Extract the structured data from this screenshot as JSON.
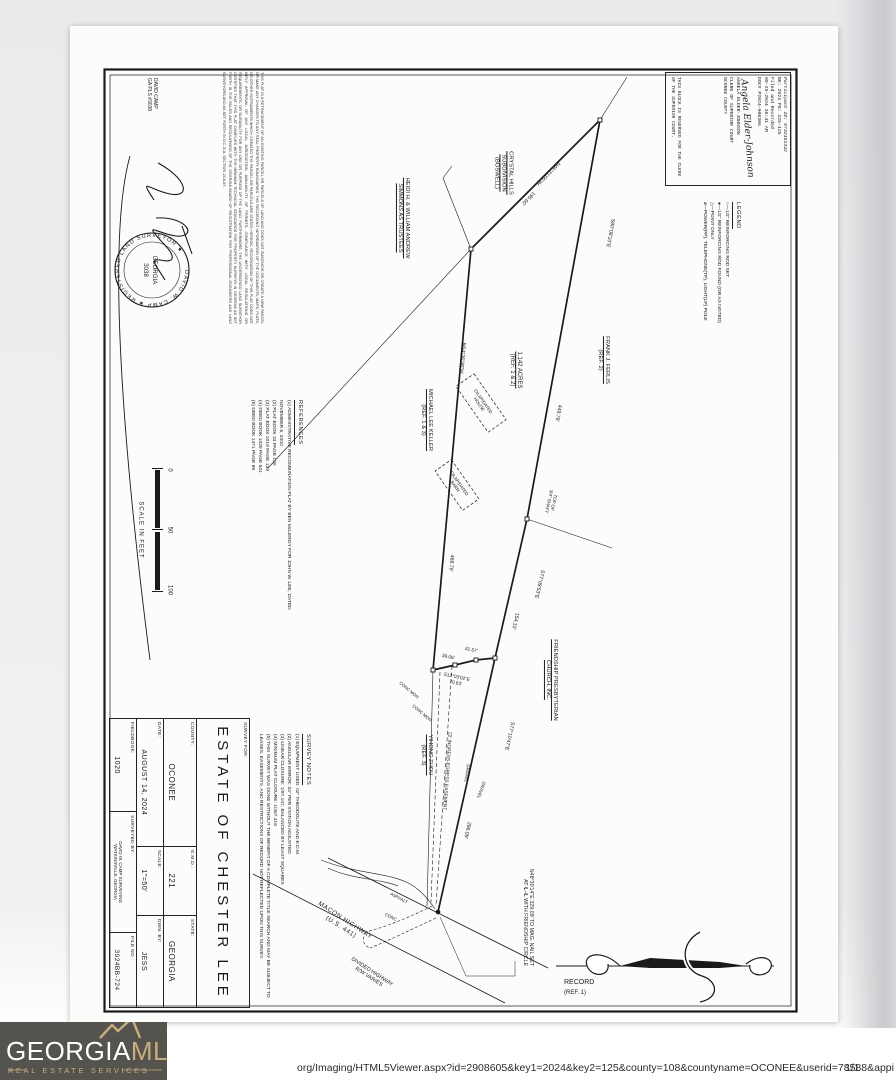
{
  "viewer": {
    "url_text": "org/Imaging/HTML5Viewer.aspx?id=2908605&key1=2024&key2=125&county=108&countyname=OCONEE&userid=78588&appi",
    "page_indicator": "1/1"
  },
  "logo": {
    "name_primary": "GEORGIA",
    "name_accent": "MLS",
    "tagline": "REAL ESTATE SERVICES",
    "bg_color": "#55534e",
    "gold_color": "#c8ad7e"
  },
  "clerk_block": {
    "participant": "Participant ID: 8732451342",
    "book_page": "BK: 2024 PG: 125-125",
    "filed": "Filed and Recorded",
    "datetime": "08-29-2024 10:41 AM",
    "doc_no": "DOC# P2024-000306",
    "signature": "Angela Elder-Johnson",
    "clerk_name": "ANGELA ELDER-JOHNSON",
    "clerk_title": "CLERK OF SUPERIOR COURT",
    "county": "OCONEE COUNTY",
    "reserved_note": "THIS BLOCK IS RESERVED FOR THE CLERK OF THE SUPERIOR COURT."
  },
  "legend": {
    "title": "LEGEND",
    "items": [
      "○—1/2\" REINFORCING ROD SET",
      "●—1/2\" REINFORCING ROD FOUND (OR AS NOTED)",
      "△—POINT ONLY",
      "⌀—POWER(PP), TELEPHONE(TP), LIGHT(LP) POLE"
    ]
  },
  "certification": {
    "text": "THIS PLAT IS A RETRACEMENT OF AN EXISTING PARCEL OR PARCELS OF LAND AND DOES NOT SUBDIVIDE OR CREATE A NEW PARCEL OR MAKE ANY CHANGES TO ANY REAL PROPERTY BOUNDARIES. THE RECORDING INFORMATION OF THE DOCUMENTS, MAPS, PLATS, OR OTHER INSTRUMENTS WHICH CREATED THE PARCEL OR PARCELS ARE STATED HEREON. RECORDATION OF THIS PLAT DOES NOT IMPLY APPROVAL OF ANY LOCAL JURISDICTION, AVAILABILITY OF PERMITS, COMPLIANCE WITH LOCAL REGULATIONS OR REQUIREMENTS, OR SUITABILITY FOR ANY USE OR PURPOSE OF THE LAND. FURTHERMORE, THE UNDERSIGNED LAND SURVEYOR CERTIFIES THAT THIS PLAT COMPLIES WITH THE MINIMUM TECHNICAL STANDARDS FOR PROPERTY SURVEYS IN GEORGIA AS SET FORTH IN THE RULES AND REGULATIONS OF THE GEORGIA BOARD OF REGISTRATION FOR PROFESSIONAL ENGINEERS AND LAND SURVEYORS AND AS SET FORTH IN O.C.G.A. SECTION 15-6-67.",
    "surveyor_note": [
      "DAVID CAMP",
      "GA PLS #3038"
    ],
    "seal_ring": "DAVID W. CAMP ★ REGISTERED LAND SURVEYOR ★",
    "seal_center": [
      "GEORGIA",
      "3038"
    ]
  },
  "references": {
    "title": "REFERENCES",
    "items": [
      "(1) ADMINISTRATIVE RECOMBINATION PLAT BY BEN McLEROY FOR JOHN W. LEE, DATED NOVEMBER 6, 2000",
      "(2) PLAT BOOK 33 PAGE 100",
      "(3) PLAT BOOK 2019 PAGE 139",
      "(4) DEED BOOK 1029 PAGE 501",
      "(5) DEED BOOK 1471 PAGE 89"
    ]
  },
  "survey_notes": {
    "title": "SURVEY NOTES",
    "items": [
      "(1) EQUIPMENT USED: 02\" THEODOLITE AND E.D.M.",
      "(2) ANGULAR ERROR: 04\" PER STATION ADJUSTED",
      "(3) LINEAR CLOSURE: 1/97,107, BALANCED BY LEAST SQUARES",
      "(4) MINIMUM PLAT CLOSURE: 1/467,316",
      "(5) THIS SURVEY WAS DONE WITHOUT THE BENEFIT OF A COMPLETE TITLE SEARCH AND MAY BE SUBJECT TO LEASES, EASEMENTS, AND RESTRICTIONS OF RECORD NOT REFLECTED UPON THIS SURVEY."
    ]
  },
  "scale_bar": {
    "ticks": [
      "0",
      "50",
      "100"
    ],
    "caption": "SCALE IN FEET"
  },
  "title_block": {
    "survey_for_label": "SURVEY FOR:",
    "client_name": "ESTATE OF CHESTER LEE",
    "county_label": "COUNTY:",
    "county": "OCONEE",
    "gmd_label": "G.M.D.:",
    "gmd": "221",
    "state_label": "STATE:",
    "state": "GEORGIA",
    "date_label": "DATE:",
    "date": "AUGUST 14, 2024",
    "scale_label": "SCALE:",
    "scale": "1\"=50'",
    "drawn_label": "DWN. BY:",
    "drawn_by": "JESS",
    "fieldbook_label": "FIELDBOOK:",
    "fieldbook": "1020",
    "surveyed_label": "SURVEYED BY:",
    "surveyed_by": [
      "DAVID W. CAMP SURVEYING",
      "WATKINSVILLE, GEORGIA"
    ],
    "file_label": "FILE NO.:",
    "file_no": "3924BB-724"
  },
  "parcel": {
    "area": [
      "1.142 ACRES",
      "(REF. 1 & 2)"
    ],
    "calls": {
      "ab": {
        "bearing": "N46°21'05\"W",
        "distance": "195.60'"
      },
      "ae": {
        "bearing": "S80°08'10\"E",
        "distance": "449.78'"
      },
      "bc": {
        "bearing": "N64°26'38\"W",
        "distance": "468.79'"
      },
      "ef": {
        "bearing": "S77°08'53\"E",
        "distance": "154.10'"
      },
      "fg": {
        "bearing": "S77°10'47\"E",
        "distance": "286.09'"
      },
      "jog": {
        "bearing": "S12°03'02\"E",
        "distance": "70.63'"
      },
      "jog1": "31.57'",
      "jog2": "39.06'"
    },
    "adjoiners": {
      "crystal_hills": [
        "CRYSTAL HILLS",
        "SUBDIVISION",
        "(BOSWELL)"
      ],
      "simmons": [
        "HEIDI H. & WILLIAM ANDREW",
        "SIMMONS AS TRUSTEES"
      ],
      "ferlis": [
        "FRANK J. FERLIS",
        "(REF. 2)"
      ],
      "keller": [
        "MICHAEL LEE KELLER",
        "(REF. 1 & 3)"
      ],
      "church": [
        "FRIENDSHIP PRESBYTERIAN",
        "CHURCH, INC."
      ],
      "zhou": [
        "YIHONG ZHOU",
        "(REF. 3)"
      ]
    },
    "features": {
      "shaft": [
        "TOP OF",
        "3/4\" SHAFT"
      ],
      "conc_mon": "CONC MON",
      "easement": "22' INGRESS-EGRESS EASEMENT",
      "gravel": "GRAVEL",
      "asphalt": "ASPHALT",
      "conc": "CONC",
      "house": [
        "DILAPIDATED",
        "HOUSE"
      ],
      "barn": [
        "DILAPIDATED",
        "BARN"
      ],
      "mag_nail": [
        "N48°30'14\"E 329.09' TO MAG. NAIL SET",
        "AT ℄–℄ WITH FRIENDSHIP CIRCLE"
      ]
    },
    "roads": {
      "macon": [
        "MACON HIGHWAY",
        "(U.S. 441)"
      ],
      "divided": [
        "DIVIDED HIGHWAY",
        "R/W VARIES"
      ]
    },
    "record": [
      "RECORD",
      "(REF. 1)"
    ]
  }
}
